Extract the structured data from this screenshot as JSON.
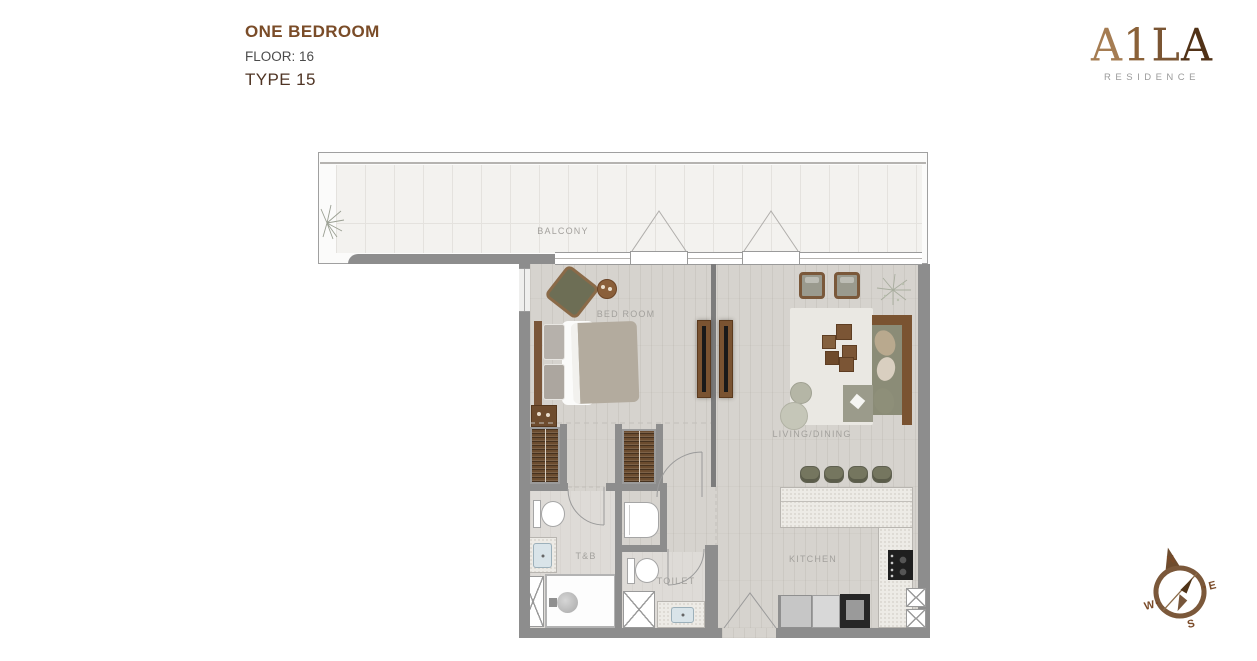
{
  "header": {
    "title": "ONE BEDROOM",
    "floor": "FLOOR: 16",
    "type": "TYPE 15"
  },
  "logo": {
    "letters": [
      "A",
      "1",
      "L",
      "A"
    ],
    "tagline": "RESIDENCE"
  },
  "labels": {
    "balcony": "BALCONY",
    "bedroom": "BED ROOM",
    "living": "LIVING/DINING",
    "tb": "T&B",
    "toilet": "TOILET",
    "kitchen": "KITCHEN"
  },
  "compass": {
    "n": "N",
    "e": "E",
    "s": "S",
    "w": "W"
  },
  "colors": {
    "wall": "#8d8d8d",
    "wood": "#d6d3ce",
    "tile": "#f3f2ef",
    "bath": "#dedbd7",
    "counter": "#edebe6",
    "brown": "#7a4c28",
    "type-brown": "#4f3424",
    "gray-text": "#4b4b4b",
    "label": "#a3a19d",
    "wardrobe": "#6b4c2f",
    "furnwood": "#7a5331",
    "olive": "#75765f",
    "sofa": "#8b8c77",
    "rug": "#eae8e3",
    "compass": "#7a4a28",
    "logo1": "#a57c52",
    "logo2": "#8a6138",
    "logo3": "#7a5533",
    "logo4": "#513217"
  }
}
